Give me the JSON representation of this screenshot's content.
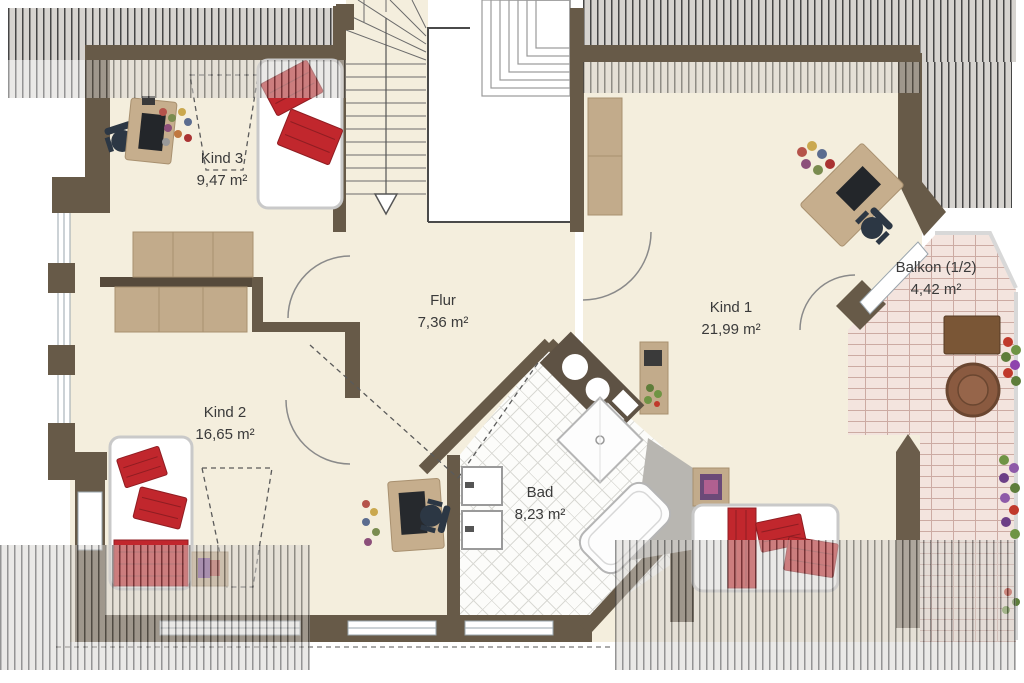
{
  "rooms": [
    {
      "id": "kind3",
      "name": "Kind 3",
      "area": "9,47 m²"
    },
    {
      "id": "kind2",
      "name": "Kind 2",
      "area": "16,65 m²"
    },
    {
      "id": "flur",
      "name": "Flur",
      "area": "7,36 m²"
    },
    {
      "id": "kind1",
      "name": "Kind 1",
      "area": "21,99 m²"
    },
    {
      "id": "bad",
      "name": "Bad",
      "area": "8,23 m²"
    },
    {
      "id": "balkon",
      "name": "Balkon (1/2)",
      "area": "4,42 m²"
    }
  ],
  "colors": {
    "wall": "#675a48",
    "floor": "#f4eedd",
    "furniture_wood": "#c6ae8d",
    "bed_red": "#c1272d",
    "balcony_tile": "#f3e4de",
    "hatch_stripe": "#454545",
    "label_ink": "#3a3a3a"
  },
  "icons": {
    "stairs_direction": "down-arrow"
  }
}
